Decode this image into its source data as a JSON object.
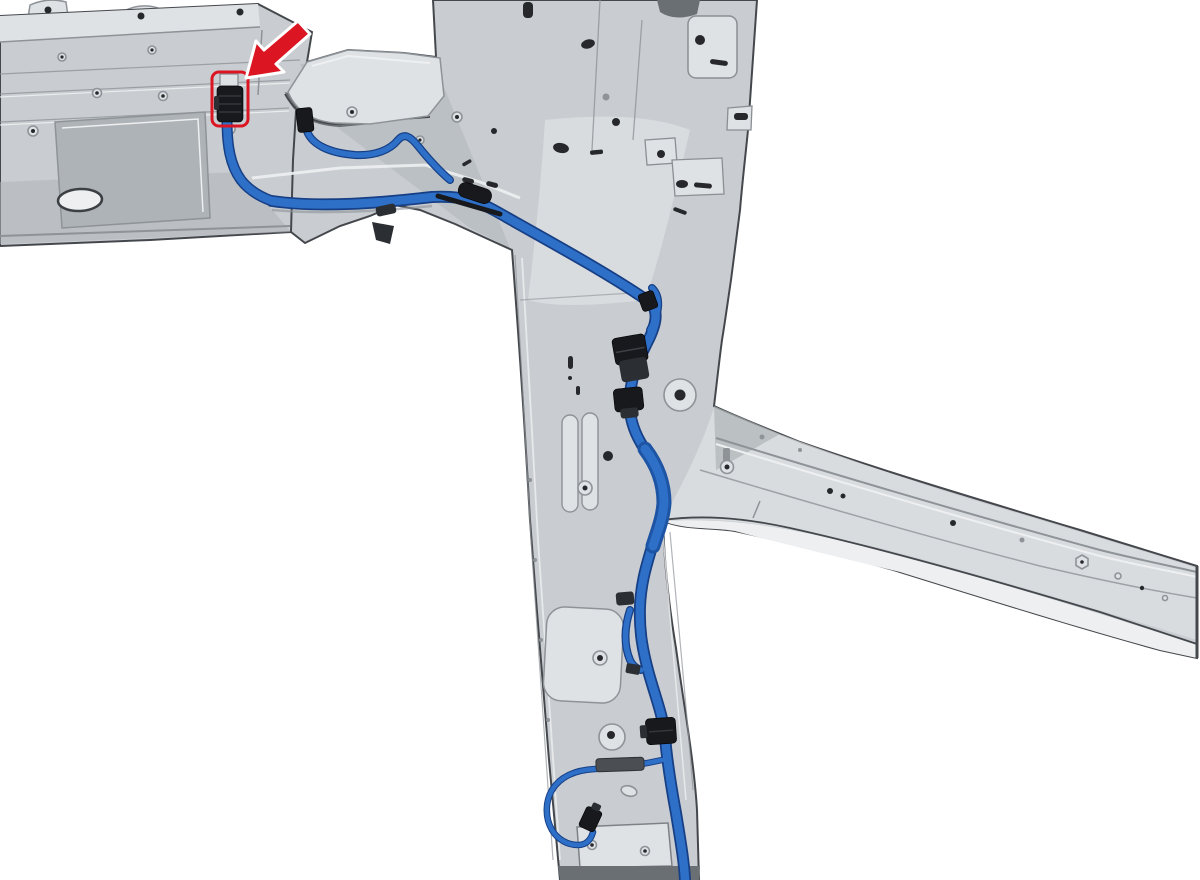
{
  "figure": {
    "type": "technical-illustration",
    "alt": "Vehicle body side structure (roof crossmember, B-pillar and roof side rail) with wiring harness routing highlighted in blue; a red arrow points to the harness connector at the roof crossmember",
    "background": "#ffffff"
  },
  "colors": {
    "metal_base": "#c9cdd1",
    "metal_light": "#dfe2e5",
    "metal_lighter": "#edeff0",
    "metal_mid": "#aeb3b7",
    "metal_dark": "#8e9398",
    "shadow": "#6a6f73",
    "hole": "#26282b",
    "edge": "#44484c",
    "blue": "#2e6fc7",
    "blue_dark": "#173f85",
    "blue_mid": "#1e54a4",
    "black": "#17191c",
    "black2": "#2b2e32",
    "gray_clip": "#4b4f53",
    "red": "#dc1522"
  },
  "callout": {
    "arrow_icon": "red-arrow-icon",
    "target": "harness-connector-highlight"
  },
  "components": {
    "structure": [
      "roof-crossmember-panel",
      "mounting-bracket",
      "junction-shelf",
      "b-pillar-inner",
      "roof-side-rail",
      "door-opening-flange",
      "rocker-end-cut"
    ],
    "harness": [
      "highlighted-connector",
      "connector-pigtail",
      "main-trunk",
      "clip-branch-wire",
      "inline-connector-pair-upper",
      "inline-connector-pair-lower",
      "taped-section",
      "box-connector",
      "lower-branch-wire",
      "lower-branch-connector"
    ]
  }
}
